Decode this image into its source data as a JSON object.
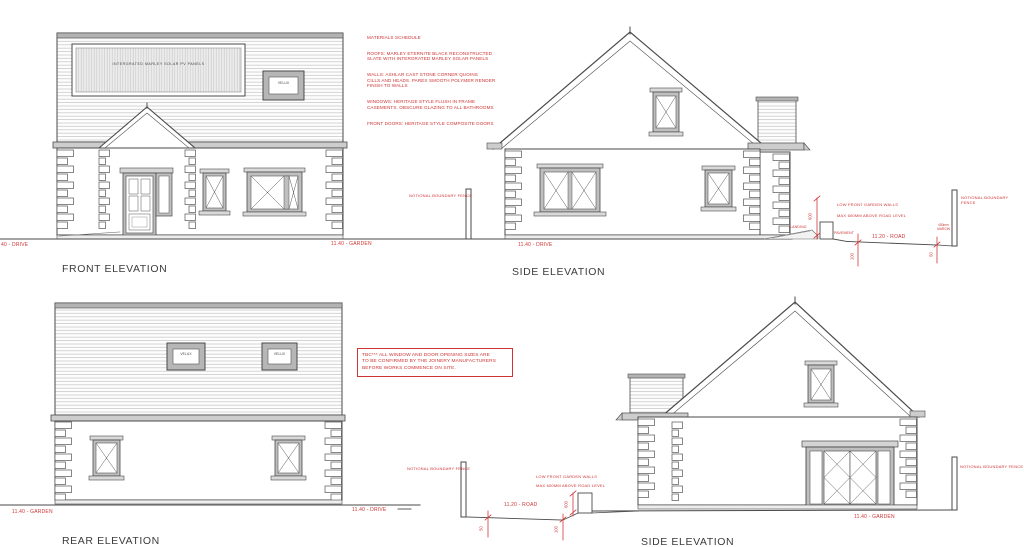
{
  "colors": {
    "red": "#cf3434",
    "line": "#4a4a4a"
  },
  "materials_schedule": {
    "title": "MATERIALS SCHEDULE",
    "roofs": "ROOFS: MARLEY ETERNITE BLACK RECONSTRUCTED\nSLATE WITH INTERGRATED MARLEY SOLAR PANELS",
    "walls": "WALLS: ASHLAR CAST STONE CORNER QUOINS\nCILLS AND HEADS.  PAREX SMOOTH POLYMER RENDER\nFINISH TO WALLS",
    "windows": "WINDOWS: HERITAGE STYLE FLUSH IN FRAME\nCASEMENTS. OBSCURE GLAZING TO ALL BATHROOMS",
    "front_doors": "FRONT DOORS: HERITAGE STYLE COMPOSITE DOORS"
  },
  "tbc_note": "TBC*** ALL WINDOW AND DOOR OPENING SIZES ARE\nTO BE CONFIRMED BY THE JOINERY MANUFACTURERS\nBEFORE WORKS COMMENCE ON SITE.",
  "front_elevation": {
    "label": "FRONT ELEVATION",
    "solar_panel_label": "INTERGRATED MARLEY SOLAR PV PANELS",
    "velux_label": "VELUX",
    "level_drive": "40 - DRIVE",
    "level_garden": "11.40 - GARDEN"
  },
  "side_elevation_top": {
    "label": "SIDE ELEVATION",
    "level_drive": "11.40 - DRIVE",
    "boundary_fence_left": "NOTIONAL BOUNDARY FENCE",
    "boundary_fence_right": "NOTIONAL BOUNDARY FENCE",
    "garden_wall_note": "LOW  FRONT GARDEN WALLS\nMAX 600MM ABOVE ROAD LEVEL",
    "landing_label": "LANDING",
    "pavement_label": "PAVEMENT",
    "road_level": "11.20 - ROAD",
    "margin_note": "450mm\nMARGIN",
    "dim_wall_height": "600",
    "dim_kerb_left": "100",
    "dim_kerb_right": "50"
  },
  "rear_elevation": {
    "label": "REAR ELEVATION",
    "velux_left_label": "VELUX",
    "velux_right_label": "VELUX",
    "level_garden": "11.40 - GARDEN",
    "level_drive": "11.40 - DRIVE"
  },
  "side_elevation_bottom": {
    "label": "SIDE ELEVATION",
    "boundary_fence_left": "NOTIONAL BOUNDARY FENCE",
    "boundary_fence_right": "NOTIONAL BOUNDARY FENCE",
    "garden_wall_note": "LOW  FRONT GARDEN WALLS\nMAX 600MM ABOVE ROAD LEVEL",
    "road_level": "11.20 - ROAD",
    "level_garden": "11.40 - GARDEN",
    "dim_kerb_left": "50",
    "dim_kerb_right": "100",
    "dim_wall_height": "600"
  }
}
